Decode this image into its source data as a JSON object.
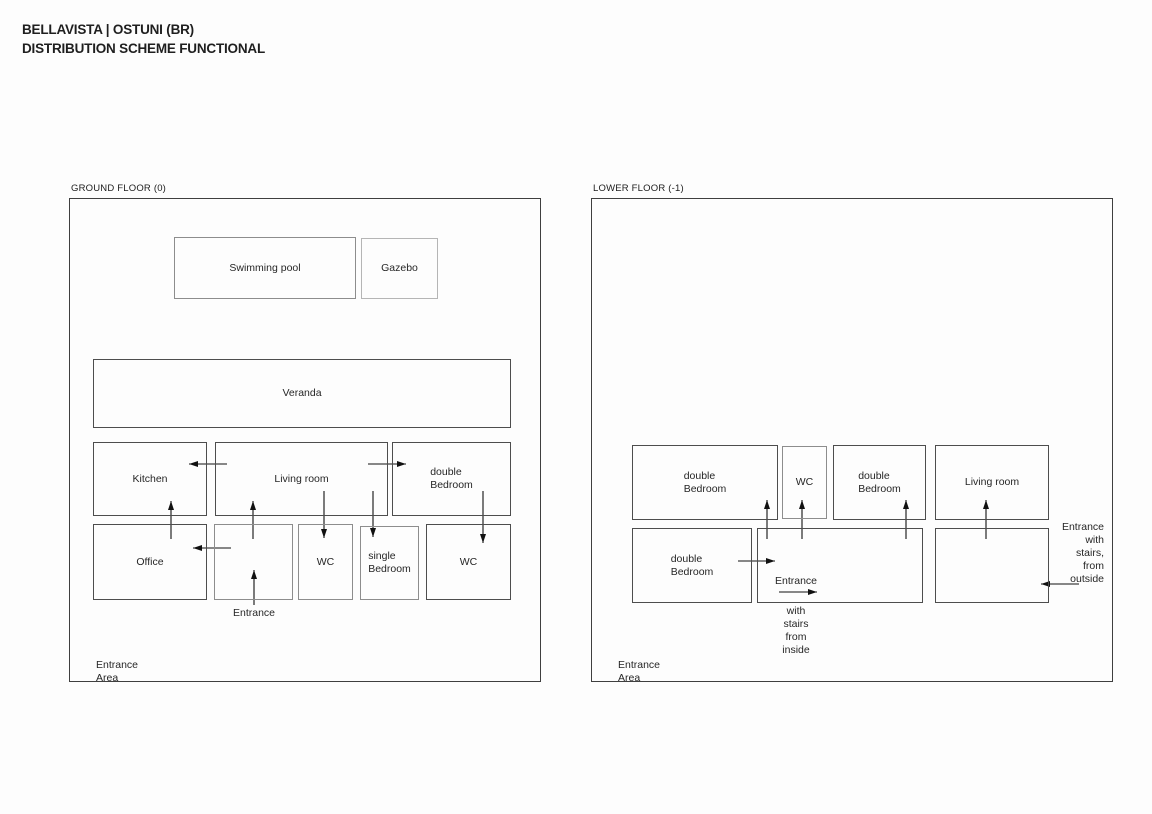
{
  "title": {
    "line1": "BELLAVISTA | OSTUNI (BR)",
    "line2": "DISTRIBUTION SCHEME FUNCTIONAL"
  },
  "colors": {
    "ink": "#1f1f1f",
    "line": "#111111",
    "panel_border": "#3f3f3f",
    "box_dark": "#4d4d4d",
    "box_medium": "#8d8d8d",
    "box_light": "#b5b5b5",
    "background": "#fdfdfd"
  },
  "floors": [
    {
      "id": "ground-floor",
      "label": "GROUND FLOOR (0)",
      "rooms": [
        {
          "id": "swimming-pool",
          "label": "Swimming pool",
          "tone": "medium",
          "x": 104,
          "y": 38,
          "w": 182,
          "h": 62
        },
        {
          "id": "gazebo",
          "label": "Gazebo",
          "tone": "light",
          "x": 291,
          "y": 39,
          "w": 77,
          "h": 61
        },
        {
          "id": "veranda",
          "label": "Veranda",
          "tone": "dark",
          "x": 23,
          "y": 160,
          "w": 418,
          "h": 69
        },
        {
          "id": "kitchen",
          "label": "Kitchen",
          "tone": "dark",
          "x": 23,
          "y": 243,
          "w": 114,
          "h": 74
        },
        {
          "id": "living-room",
          "label": "Living room",
          "tone": "dark",
          "x": 145,
          "y": 243,
          "w": 173,
          "h": 74
        },
        {
          "id": "double-bedroom",
          "label": "double\nBedroom",
          "tone": "dark",
          "x": 322,
          "y": 243,
          "w": 119,
          "h": 74
        },
        {
          "id": "office",
          "label": "Office",
          "tone": "dark",
          "x": 23,
          "y": 325,
          "w": 114,
          "h": 76
        },
        {
          "id": "entrance-hall",
          "label": "",
          "tone": "medium",
          "x": 144,
          "y": 325,
          "w": 79,
          "h": 76
        },
        {
          "id": "wc-1",
          "label": "WC",
          "tone": "medium",
          "x": 228,
          "y": 325,
          "w": 55,
          "h": 76
        },
        {
          "id": "single-bedroom",
          "label": "single\nBedroom",
          "tone": "medium",
          "x": 290,
          "y": 327,
          "w": 59,
          "h": 74
        },
        {
          "id": "wc-2",
          "label": "WC",
          "tone": "dark",
          "x": 356,
          "y": 325,
          "w": 85,
          "h": 76
        }
      ],
      "annotations": [
        {
          "name": "entrance-label",
          "text": "Entrance",
          "x": 184,
          "y": 408,
          "align": "center"
        },
        {
          "name": "entrance-area-label",
          "text": "Entrance Area",
          "x": 26,
          "y": 460,
          "align": "left"
        }
      ],
      "arrows": [
        {
          "name": "living-to-kitchen",
          "x1": 157,
          "y1": 265,
          "x2": 119,
          "y2": 265
        },
        {
          "name": "living-to-double-bedroom",
          "x1": 298,
          "y1": 265,
          "x2": 336,
          "y2": 265
        },
        {
          "name": "up-into-kitchen",
          "x1": 101,
          "y1": 340,
          "x2": 101,
          "y2": 302
        },
        {
          "name": "up-into-living-room",
          "x1": 183,
          "y1": 340,
          "x2": 183,
          "y2": 302
        },
        {
          "name": "down-into-wc-1",
          "x1": 254,
          "y1": 292,
          "x2": 254,
          "y2": 339
        },
        {
          "name": "down-into-single-bedroom",
          "x1": 303,
          "y1": 292,
          "x2": 303,
          "y2": 338
        },
        {
          "name": "down-into-wc-2",
          "x1": 413,
          "y1": 292,
          "x2": 413,
          "y2": 344
        },
        {
          "name": "entrance-to-office",
          "x1": 161,
          "y1": 349,
          "x2": 123,
          "y2": 349
        },
        {
          "name": "up-into-entrance-hall",
          "x1": 184,
          "y1": 406,
          "x2": 184,
          "y2": 371
        }
      ]
    },
    {
      "id": "lower-floor",
      "label": "LOWER FLOOR (-1)",
      "rooms": [
        {
          "id": "double-bedroom-1",
          "label": "double\nBedroom",
          "tone": "dark",
          "x": 40,
          "y": 246,
          "w": 146,
          "h": 75
        },
        {
          "id": "wc",
          "label": "WC",
          "tone": "medium",
          "x": 190,
          "y": 247,
          "w": 45,
          "h": 73
        },
        {
          "id": "double-bedroom-2",
          "label": "double\nBedroom",
          "tone": "dark",
          "x": 241,
          "y": 246,
          "w": 93,
          "h": 75
        },
        {
          "id": "living-room",
          "label": "Living room",
          "tone": "dark",
          "x": 343,
          "y": 246,
          "w": 114,
          "h": 75
        },
        {
          "id": "double-bedroom-3",
          "label": "double\nBedroom",
          "tone": "dark",
          "x": 40,
          "y": 329,
          "w": 120,
          "h": 75
        },
        {
          "id": "entrance-hall",
          "label": "",
          "tone": "dark",
          "x": 165,
          "y": 329,
          "w": 166,
          "h": 75
        },
        {
          "id": "entry-room",
          "label": "",
          "tone": "dark",
          "x": 343,
          "y": 329,
          "w": 114,
          "h": 75
        }
      ],
      "annotations": [
        {
          "name": "entrance-label",
          "text": "Entrance",
          "x": 204,
          "y": 376,
          "align": "center"
        },
        {
          "name": "stairs-inside-note",
          "text": "with stairs\nfrom\ninside",
          "x": 204,
          "y": 406,
          "align": "center"
        },
        {
          "name": "entrance-outside-note",
          "text": "Entrance\nwith stairs,\nfrom\noutside",
          "x": 512,
          "y": 322,
          "align": "right"
        },
        {
          "name": "entrance-area-label",
          "text": "Entrance Area",
          "x": 26,
          "y": 460,
          "align": "left"
        }
      ],
      "arrows": [
        {
          "name": "up-into-double-bedroom-1",
          "x1": 175,
          "y1": 340,
          "x2": 175,
          "y2": 301
        },
        {
          "name": "up-into-wc",
          "x1": 210,
          "y1": 340,
          "x2": 210,
          "y2": 301
        },
        {
          "name": "up-into-double-bedroom-2",
          "x1": 314,
          "y1": 340,
          "x2": 314,
          "y2": 301
        },
        {
          "name": "up-into-living-room",
          "x1": 394,
          "y1": 340,
          "x2": 394,
          "y2": 301
        },
        {
          "name": "bedroom-to-hall",
          "x1": 146,
          "y1": 362,
          "x2": 183,
          "y2": 362
        },
        {
          "name": "entrance-inside-arrow",
          "x1": 187,
          "y1": 393,
          "x2": 225,
          "y2": 393
        },
        {
          "name": "entrance-outside-arrow",
          "x1": 487,
          "y1": 385,
          "x2": 449,
          "y2": 385
        }
      ]
    }
  ]
}
